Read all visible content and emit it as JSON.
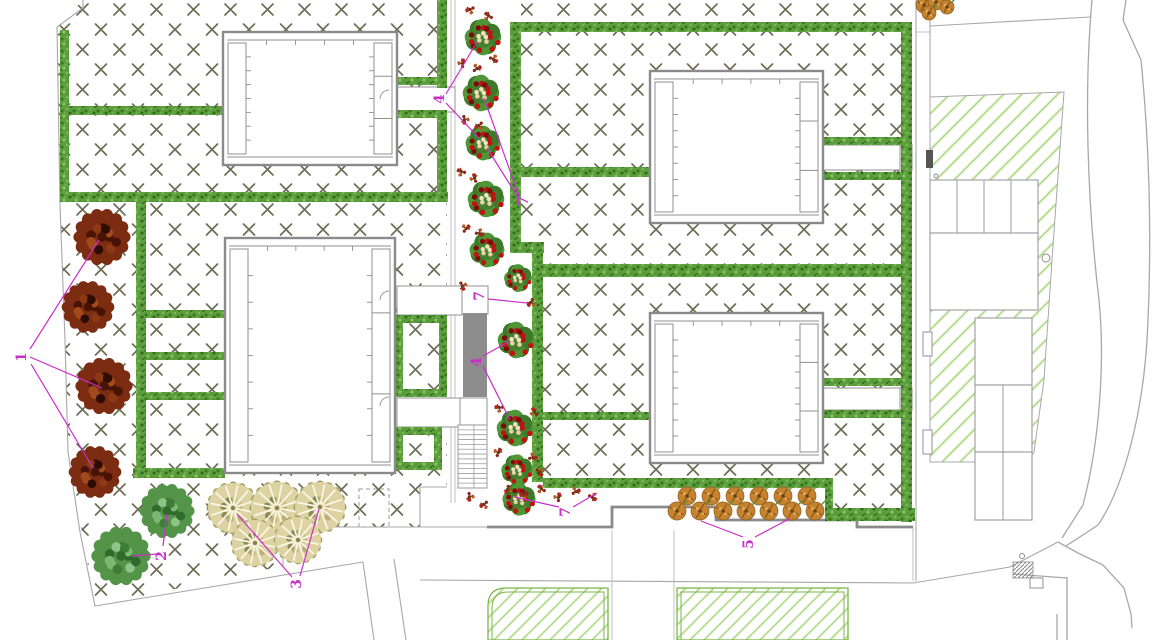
{
  "title": "landscape-site-plan",
  "labels": [
    {
      "text": "1",
      "x": 22,
      "y": 357,
      "leaders": [
        [
          30,
          349,
          99,
          240
        ],
        [
          30,
          357,
          102,
          388
        ],
        [
          31,
          364,
          93,
          468
        ]
      ]
    },
    {
      "text": "2",
      "x": 162,
      "y": 556,
      "leaders": [
        [
          157,
          554,
          131,
          556
        ],
        [
          163,
          546,
          167,
          514
        ]
      ]
    },
    {
      "text": "3",
      "x": 297,
      "y": 584,
      "leaders": [
        [
          292,
          577,
          237,
          514
        ],
        [
          300,
          576,
          319,
          509
        ]
      ]
    },
    {
      "text": "4",
      "x": 440,
      "y": 99,
      "leaders": [
        [
          446,
          94,
          477,
          42
        ],
        [
          446,
          103,
          480,
          139
        ]
      ]
    },
    {
      "text": "4",
      "x": 477,
      "y": 362,
      "leaders": [
        [
          483,
          356,
          510,
          341
        ],
        [
          483,
          366,
          510,
          420
        ]
      ]
    },
    {
      "text": "5",
      "x": 749,
      "y": 544,
      "leaders": [
        [
          743,
          537,
          701,
          521
        ],
        [
          755,
          537,
          789,
          519
        ]
      ]
    },
    {
      "text": "7",
      "x": 524,
      "y": 201,
      "leaders": [
        [
          484,
          98,
          519,
          196
        ],
        [
          487,
          148,
          519,
          199
        ]
      ]
    },
    {
      "text": "7",
      "x": 480,
      "y": 296,
      "leaders": [
        [
          488,
          299,
          527,
          303
        ]
      ]
    },
    {
      "text": "7",
      "x": 566,
      "y": 512,
      "leaders": [
        [
          559,
          507,
          514,
          497
        ],
        [
          573,
          507,
          597,
          493
        ]
      ]
    }
  ],
  "colors": {
    "hatch": "#6d6d55",
    "hedgeBase": "#5d9f3e",
    "diag": "#b9df97",
    "lawnLine": "#79b649",
    "wall": "#8a8a8a",
    "line": "#a8a8a8",
    "thin": "#b9b9b9",
    "magenta": "#c92fc9",
    "rampFill": "#8d8d8d",
    "buildingLine": "#8f8f8f",
    "white": "#ffffff",
    "treeRed": "#7b2c11",
    "treeGreen": "#539449",
    "treeTan": "#ddd3a2",
    "flowerRed": "#c11212",
    "flowerTan": "#c5832f",
    "cream": "#f1e2c0"
  },
  "plan": {
    "hatchPolys": [
      {
        "pat": "x",
        "pts": [
          [
            83,
            0
          ],
          [
            447,
            0
          ],
          [
            447,
            487
          ],
          [
            420,
            487
          ],
          [
            420,
            527
          ],
          [
            283,
            527
          ],
          [
            283,
            566
          ],
          [
            95,
            606
          ],
          [
            68,
            452
          ],
          [
            65,
            340
          ],
          [
            60,
            205
          ],
          [
            57,
            27
          ]
        ]
      },
      {
        "pat": "x",
        "pts": [
          [
            521,
            0
          ],
          [
            912,
            0
          ],
          [
            912,
            522
          ],
          [
            830,
            522
          ],
          [
            830,
            487
          ],
          [
            678,
            487
          ],
          [
            678,
            482
          ],
          [
            543,
            482
          ],
          [
            543,
            253
          ],
          [
            521,
            253
          ]
        ]
      },
      {
        "pat": "diag",
        "stroke": true,
        "pts": [
          [
            930,
            97
          ],
          [
            1064,
            92
          ],
          [
            1052,
            260
          ],
          [
            1044,
            380
          ],
          [
            1034,
            452
          ],
          [
            1028,
            462
          ],
          [
            930,
            462
          ]
        ]
      }
    ],
    "boundaries": [
      [
        [
          83,
          0
        ],
        [
          83,
          8
        ],
        [
          57,
          27
        ],
        [
          60,
          205
        ],
        [
          65,
          340
        ],
        [
          68,
          452
        ],
        [
          80,
          532
        ],
        [
          95,
          606
        ],
        [
          363,
          562
        ]
      ],
      [
        [
          363,
          562
        ],
        [
          374,
          640
        ]
      ],
      [
        [
          394,
          559
        ],
        [
          406,
          640
        ]
      ],
      [
        [
          283,
          566
        ],
        [
          283,
          527
        ],
        [
          487,
          527
        ]
      ],
      [
        [
          447,
          487
        ],
        [
          420,
          487
        ],
        [
          420,
          527
        ]
      ],
      [
        [
          916,
          0
        ],
        [
          916,
          581
        ]
      ],
      [
        [
          930,
          0
        ],
        [
          930,
          97
        ]
      ],
      [
        [
          930,
          26
        ],
        [
          1090,
          17
        ]
      ],
      [
        [
          913,
          583
        ],
        [
          1010,
          567
        ],
        [
          1058,
          542
        ]
      ],
      [
        [
          420,
          580
        ],
        [
          913,
          583
        ]
      ]
    ],
    "roads": [
      "M1092,0 C1084,90 1087,200 1099,300 C1105,360 1100,440 1083,505 L1062,538",
      "M1126,0 L1123,20 L1141,60 C1150,150 1152,250 1147,340 C1142,420 1122,490 1098,525 L1066,546",
      "M1058,542 L1078,553 L1103,565 L1124,588 L1131,614 L1132,628",
      "M1013,574 L1067,578",
      "M1067,577 L1067,640",
      "M1057,614 L1057,640"
    ],
    "thinLines": [
      [
        451,
        0,
        451,
        503
      ],
      [
        455,
        0,
        455,
        503
      ],
      [
        612,
        530,
        612,
        640
      ],
      [
        674,
        530,
        674,
        640
      ],
      [
        913,
        527,
        913,
        581
      ],
      [
        916,
        32,
        930,
        32
      ]
    ],
    "thickWall": "M487,527 L612,527 L612,507 L716,507 L716,520 L857,520 L857,527 L913,527",
    "dashedRects": [
      [
        359,
        489,
        30,
        38
      ]
    ],
    "whiteRects": [
      [
        397,
        87,
        58,
        25
      ],
      [
        397,
        286,
        65,
        29
      ],
      [
        397,
        398,
        65,
        29
      ],
      [
        823,
        145,
        87,
        25
      ],
      [
        823,
        388,
        87,
        22
      ],
      [
        900,
        145,
        12,
        25
      ],
      [
        900,
        388,
        12,
        22
      ],
      [
        462,
        286,
        26,
        28
      ],
      [
        460,
        398,
        27,
        27
      ],
      [
        930,
        180,
        108,
        53
      ],
      [
        930,
        233,
        108,
        77
      ],
      [
        975,
        318,
        57,
        67
      ],
      [
        975,
        385,
        57,
        67
      ],
      [
        975,
        452,
        57,
        68
      ],
      [
        923,
        332,
        9,
        24
      ],
      [
        923,
        430,
        9,
        24
      ],
      [
        1030,
        578,
        13,
        10
      ]
    ],
    "parkingLines": [
      [
        957,
        180,
        957,
        233
      ],
      [
        984,
        180,
        984,
        233
      ],
      [
        1011,
        180,
        1011,
        233
      ],
      [
        1003,
        385,
        1003,
        520
      ]
    ],
    "hedges": [
      [
        60,
        30,
        9,
        163
      ],
      [
        60,
        106,
        163,
        9
      ],
      [
        60,
        192,
        388,
        10
      ],
      [
        136,
        202,
        10,
        268
      ],
      [
        136,
        310,
        88,
        8
      ],
      [
        136,
        352,
        88,
        8
      ],
      [
        136,
        392,
        88,
        8
      ],
      [
        133,
        468,
        92,
        10
      ],
      [
        437,
        0,
        10,
        88
      ],
      [
        437,
        110,
        10,
        83
      ],
      [
        397,
        77,
        42,
        8
      ],
      [
        397,
        110,
        42,
        8
      ],
      [
        510,
        22,
        11,
        231
      ],
      [
        510,
        242,
        34,
        11
      ],
      [
        532,
        253,
        11,
        229
      ],
      [
        518,
        22,
        394,
        10
      ],
      [
        520,
        167,
        130,
        10
      ],
      [
        823,
        137,
        79,
        8
      ],
      [
        823,
        172,
        79,
        8
      ],
      [
        543,
        264,
        369,
        13
      ],
      [
        543,
        412,
        107,
        8
      ],
      [
        823,
        378,
        79,
        8
      ],
      [
        823,
        410,
        79,
        8
      ],
      [
        901,
        22,
        11,
        500
      ],
      [
        543,
        478,
        282,
        10
      ],
      [
        825,
        478,
        8,
        36
      ],
      [
        825,
        508,
        90,
        13
      ]
    ],
    "hedgeFrames": [
      [
        395,
        315,
        52,
        82,
        8
      ],
      [
        395,
        427,
        47,
        43,
        8
      ]
    ],
    "lawns": {
      "outer1": "M506,588 L608,588 L608,640 L488,640 L488,606 Q488,588 506,588 Z",
      "inner1": "M508,592 L604,592 L604,640 L492,640 L492,608 Q492,592 508,592 Z",
      "outer2": [
        677,
        588,
        171,
        52
      ],
      "inner2": [
        681,
        592,
        163,
        48
      ]
    },
    "buildings": [
      {
        "x": 223,
        "y": 32,
        "w": 174,
        "h": 133
      },
      {
        "x": 225,
        "y": 238,
        "w": 170,
        "h": 235
      },
      {
        "x": 650,
        "y": 71,
        "w": 173,
        "h": 152
      },
      {
        "x": 650,
        "y": 313,
        "w": 173,
        "h": 150
      }
    ],
    "doors": [
      [
        389,
        99
      ],
      [
        389,
        300
      ],
      [
        389,
        406
      ]
    ],
    "ramp": [
      463,
      313,
      24,
      84
    ],
    "stairs": {
      "x": 458,
      "y": 425,
      "w": 29,
      "h": 63,
      "steps": 13
    },
    "circles": [
      [
        1022,
        556,
        2.5
      ],
      [
        1046,
        258,
        4
      ],
      [
        936,
        176,
        2
      ]
    ],
    "crosswalk": [
      1013,
      562,
      20,
      16
    ],
    "darkTicks": [
      [
        926,
        150,
        7,
        18
      ]
    ],
    "plants": {
      "redTrees": [
        [
          102,
          237,
          26
        ],
        [
          88,
          307,
          24
        ],
        [
          104,
          386,
          26
        ],
        [
          95,
          472,
          24
        ]
      ],
      "greenTrees": [
        [
          121,
          556,
          27
        ],
        [
          167,
          511,
          25
        ]
      ],
      "tanTrees": [
        [
          233,
          508,
          25
        ],
        [
          277,
          508,
          26
        ],
        [
          320,
          507,
          25
        ],
        [
          255,
          543,
          23
        ],
        [
          298,
          540,
          23
        ]
      ],
      "clusters": [
        [
          483,
          37,
          21
        ],
        [
          481,
          93,
          21
        ],
        [
          483,
          143,
          20
        ],
        [
          486,
          199,
          21
        ],
        [
          487,
          250,
          20
        ],
        [
          518,
          278,
          16
        ],
        [
          516,
          340,
          21
        ],
        [
          515,
          428,
          21
        ],
        [
          517,
          470,
          18
        ],
        [
          519,
          499,
          19
        ]
      ],
      "sprigs": [
        [
          470,
          10
        ],
        [
          488,
          16
        ],
        [
          462,
          63
        ],
        [
          477,
          68
        ],
        [
          494,
          59
        ],
        [
          465,
          120
        ],
        [
          479,
          126
        ],
        [
          461,
          172
        ],
        [
          474,
          178
        ],
        [
          466,
          228
        ],
        [
          480,
          233
        ],
        [
          463,
          286
        ],
        [
          531,
          303
        ],
        [
          499,
          408
        ],
        [
          534,
          412
        ],
        [
          498,
          452
        ],
        [
          533,
          457
        ],
        [
          540,
          472
        ],
        [
          508,
          490
        ],
        [
          524,
          495
        ],
        [
          541,
          489
        ],
        [
          558,
          497
        ],
        [
          576,
          491
        ],
        [
          593,
          497
        ],
        [
          470,
          497
        ],
        [
          484,
          505
        ]
      ],
      "bedFlowers": [
        [
          687,
          496,
          9
        ],
        [
          711,
          496,
          9
        ],
        [
          735,
          496,
          9
        ],
        [
          759,
          496,
          9
        ],
        [
          783,
          496,
          9
        ],
        [
          807,
          496,
          9
        ],
        [
          677,
          511,
          9
        ],
        [
          700,
          511,
          9
        ],
        [
          723,
          511,
          9
        ],
        [
          746,
          511,
          9
        ],
        [
          769,
          511,
          9
        ],
        [
          792,
          511,
          9
        ],
        [
          815,
          511,
          9
        ]
      ],
      "topShrub": [
        [
          924,
          5,
          8
        ],
        [
          936,
          2,
          8
        ],
        [
          947,
          7,
          7
        ],
        [
          929,
          13,
          7
        ]
      ]
    }
  }
}
